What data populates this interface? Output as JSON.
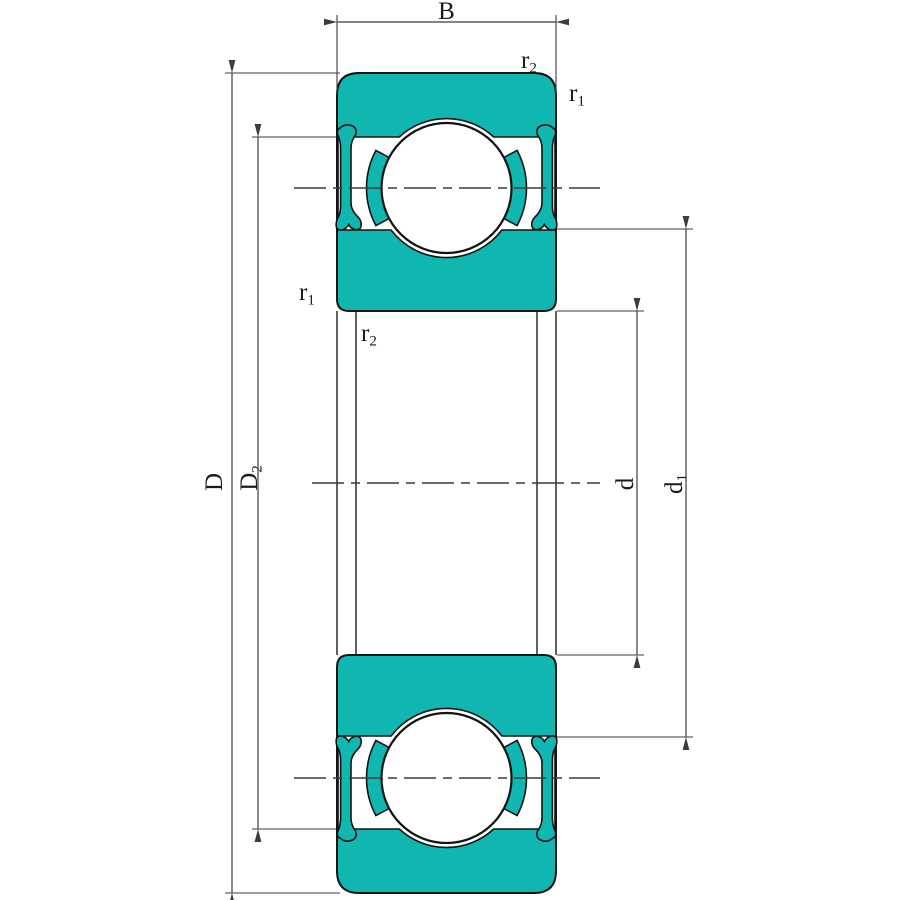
{
  "drawing": {
    "type": "deep-groove-ball-bearing-cross-section",
    "colors": {
      "ring_fill": "#10b6b0",
      "outline": "#141414",
      "dimension_line": "#3c3c3c",
      "background": "#ffffff"
    },
    "labels": {
      "width": "B",
      "outer_diameter": "D",
      "outer_shoulder": {
        "base": "D",
        "sub": "2"
      },
      "bore": "d",
      "inner_shoulder": {
        "base": "d",
        "sub": "1"
      },
      "chamfer_outer": {
        "base": "r",
        "sub": "1"
      },
      "chamfer_bore": {
        "base": "r",
        "sub": "2"
      }
    }
  }
}
